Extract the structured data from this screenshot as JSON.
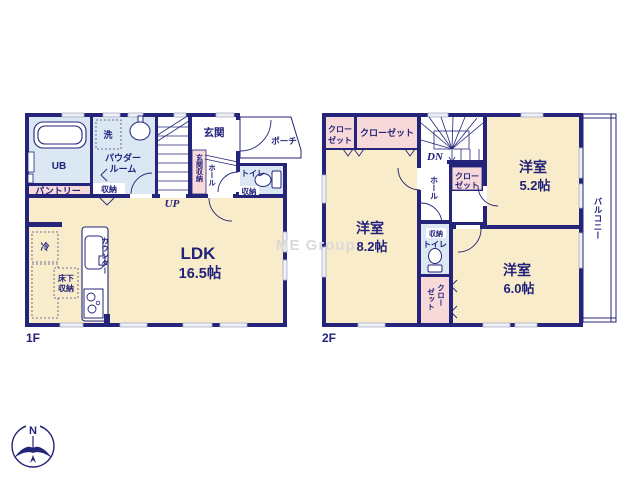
{
  "colors": {
    "wall_navy": "#24247a",
    "room_cream": "#f8ecca",
    "room_lightblue": "#dbe7f2",
    "closet_pink": "#f7d9da",
    "window_gray": "#eef0f6",
    "label_navy": "#22227a",
    "watermark_gray": "#d9d9d9"
  },
  "watermark": "ME Group",
  "compass": {
    "north": "N"
  },
  "f1": {
    "floor": "1F",
    "ub": "UB",
    "wash": "洗",
    "powder1": "パウダー",
    "powder2": "ルーム",
    "pantry": "パントリー",
    "storage": "収納",
    "stairs_dir": "UP",
    "entrance": "玄関",
    "entrance_storage": "玄関収納",
    "hall": "ホール",
    "toilet": "トイレ",
    "toilet_storage": "収納",
    "porch": "ポーチ",
    "ldk": "LDK",
    "ldk_size": "16.5帖",
    "counter": "カウンター",
    "fridge": "冷",
    "underfloor1": "床下",
    "underfloor2": "収納"
  },
  "f2": {
    "floor": "2F",
    "closet_small1": "クロー",
    "closet_small2": "ゼット",
    "closet_wide": "クローゼット",
    "stairs_dir": "DN",
    "hall": "ホール",
    "closet_mid1": "クロー",
    "closet_mid2": "ゼット",
    "room52": "洋室",
    "room52_size": "5.2帖",
    "room82": "洋室",
    "room82_size": "8.2帖",
    "storage": "収納",
    "toilet": "トイレ",
    "closet_v1": "クロー",
    "closet_v2": "ゼット",
    "room60": "洋室",
    "room60_size": "6.0帖",
    "balcony": "バルコニー"
  }
}
